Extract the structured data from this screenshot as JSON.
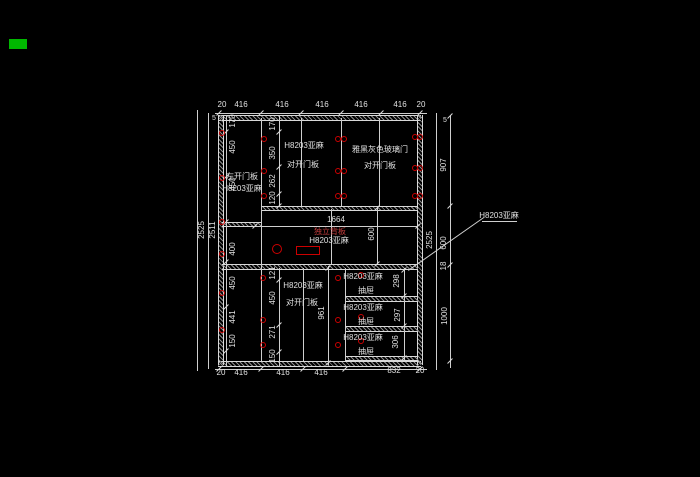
{
  "cad": {
    "colors": {
      "line": "#cfcfcf",
      "text": "#e0e0e0",
      "red_marker": "#cc0000",
      "red_text": "#c23b3b",
      "swatch_green": "#00b800"
    },
    "top_dims": [
      "20",
      "416",
      "416",
      "416",
      "416",
      "416",
      "20"
    ],
    "bottom_dims": [
      "20",
      "416",
      "416",
      "416",
      "832",
      "20"
    ],
    "overall_height_left": "2525",
    "interior_height_left": "2511",
    "overall_height_right": "2525",
    "top_gap_left": "5",
    "top_gap_right": "5",
    "left_segments": [
      "170",
      "450",
      "450",
      "400",
      "450",
      "441",
      "150"
    ],
    "upper_door_segments": [
      "170",
      "350",
      "262",
      "120"
    ],
    "lower_door_segments": [
      "121",
      "450",
      "271",
      "150"
    ],
    "right_segments": [
      "907",
      "600",
      "18",
      "1000"
    ],
    "upper_left_door": {
      "line1": "左开门板",
      "line2": "H8203亚麻"
    },
    "upper_mid_door": {
      "line1": "H8203亚麻",
      "line2": "对开门板"
    },
    "upper_right_door": {
      "line1": "雅黑灰色玻璃门",
      "line2": "对开门板"
    },
    "niche": {
      "width": "1664",
      "height": "600",
      "note_red": "独立背板",
      "note": "H8203亚麻"
    },
    "leader_label": "H8203亚麻",
    "lower_door": {
      "line1": "H8203亚麻",
      "line2": "对开门板",
      "height": "961"
    },
    "drawers": [
      {
        "material": "H8203亚麻",
        "label": "抽屉",
        "height": "298"
      },
      {
        "material": "H8203亚麻",
        "label": "抽屉",
        "height": "297"
      },
      {
        "material": "H8203亚麻",
        "label": "抽屉",
        "height": "306"
      }
    ]
  }
}
